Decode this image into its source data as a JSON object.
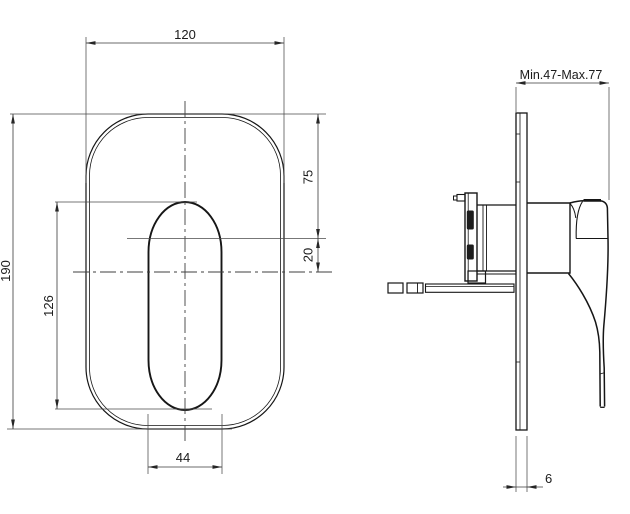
{
  "front_view": {
    "plate_width": "120",
    "plate_height": "190",
    "handle_height": "126",
    "handle_width": "44",
    "center_from_top": "75",
    "center_offset": "20"
  },
  "side_view": {
    "depth_range": "Min.47-Max.77",
    "plate_thickness": "6"
  }
}
